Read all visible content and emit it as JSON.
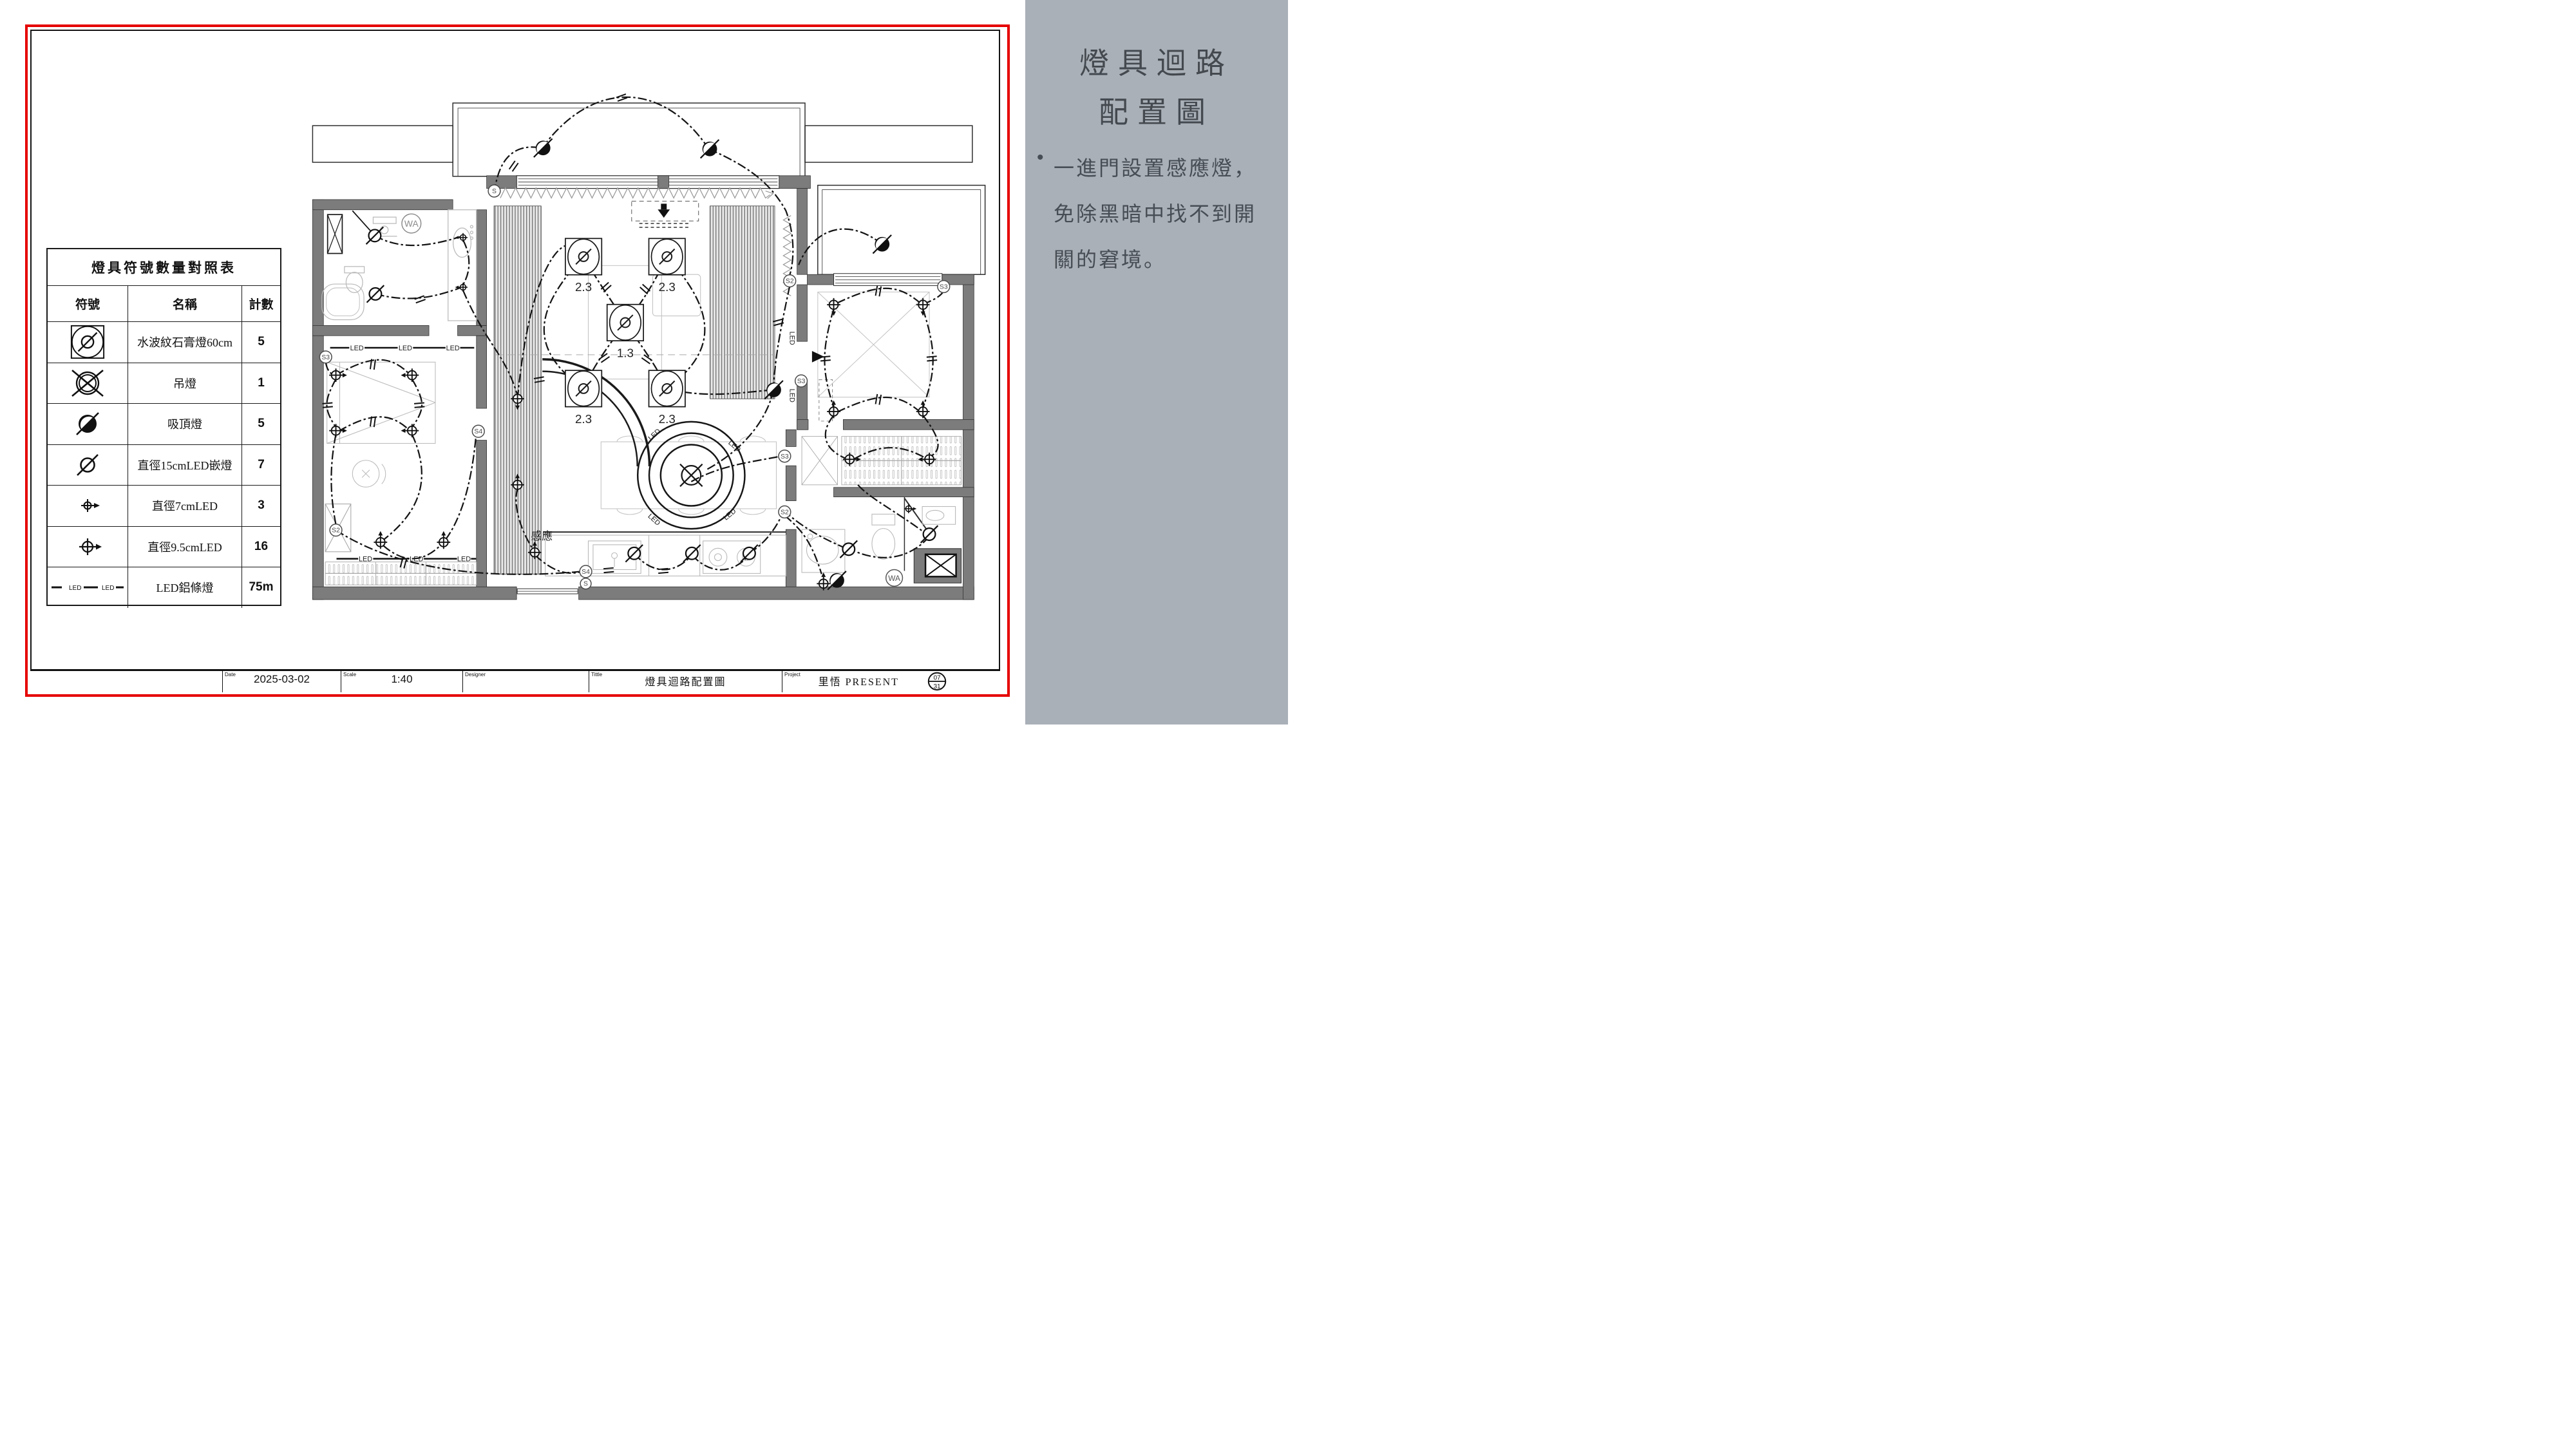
{
  "sidebar": {
    "title_line1": "燈具迴路",
    "title_line2": "配置圖",
    "bullet": "•",
    "para_line1": "一進門設置感應燈，",
    "para_line2": "免除黑暗中找不到開",
    "para_line3": "關的窘境。",
    "bg_color": "#aab0b7",
    "text_color": "#43494f"
  },
  "legend": {
    "title": "燈具符號數量對照表",
    "col_symbol": "符號",
    "col_name": "名稱",
    "col_count": "計數",
    "rows": [
      {
        "symbol": "gypsum-water-ripple-lamp",
        "name": "水波紋石膏燈60cm",
        "count": "5"
      },
      {
        "symbol": "pendant-lamp",
        "name": "吊燈",
        "count": "1"
      },
      {
        "symbol": "ceiling-lamp",
        "name": "吸頂燈",
        "count": "5"
      },
      {
        "symbol": "downlight-15cm",
        "name": "直徑15cmLED嵌燈",
        "count": "7"
      },
      {
        "symbol": "led-7cm",
        "name": "直徑7cmLED",
        "count": "3"
      },
      {
        "symbol": "led-9-5cm",
        "name": "直徑9.5cmLED",
        "count": "16"
      },
      {
        "symbol": "led-strip",
        "name": "LED鋁條燈",
        "count": "75m",
        "symbol_text": "LED"
      }
    ]
  },
  "titleblock": {
    "date_label": "Date",
    "date_value": "2025-03-02",
    "scale_label": "Scale",
    "scale_value": "1:40",
    "designer_label": "Designer",
    "designer_value": "",
    "title_label": "Tittle",
    "title_value": "燈具迴路配置圖",
    "project_label": "Project",
    "project_value": "里悟 PRESENT",
    "sheet_top": "07",
    "sheet_bottom": "31"
  },
  "plan": {
    "gypsum_labels": [
      "2.3",
      "2.3",
      "1.3",
      "2.3",
      "2.3"
    ],
    "sensor_label": "感應",
    "wa_label": "WA",
    "led_label": "LED",
    "s": "S",
    "s2": "S2",
    "s3": "S3",
    "s4": "S4"
  },
  "colors": {
    "frame_red": "#e60000",
    "wall_gray": "#7c7c7c",
    "circuit_black": "#141414"
  }
}
